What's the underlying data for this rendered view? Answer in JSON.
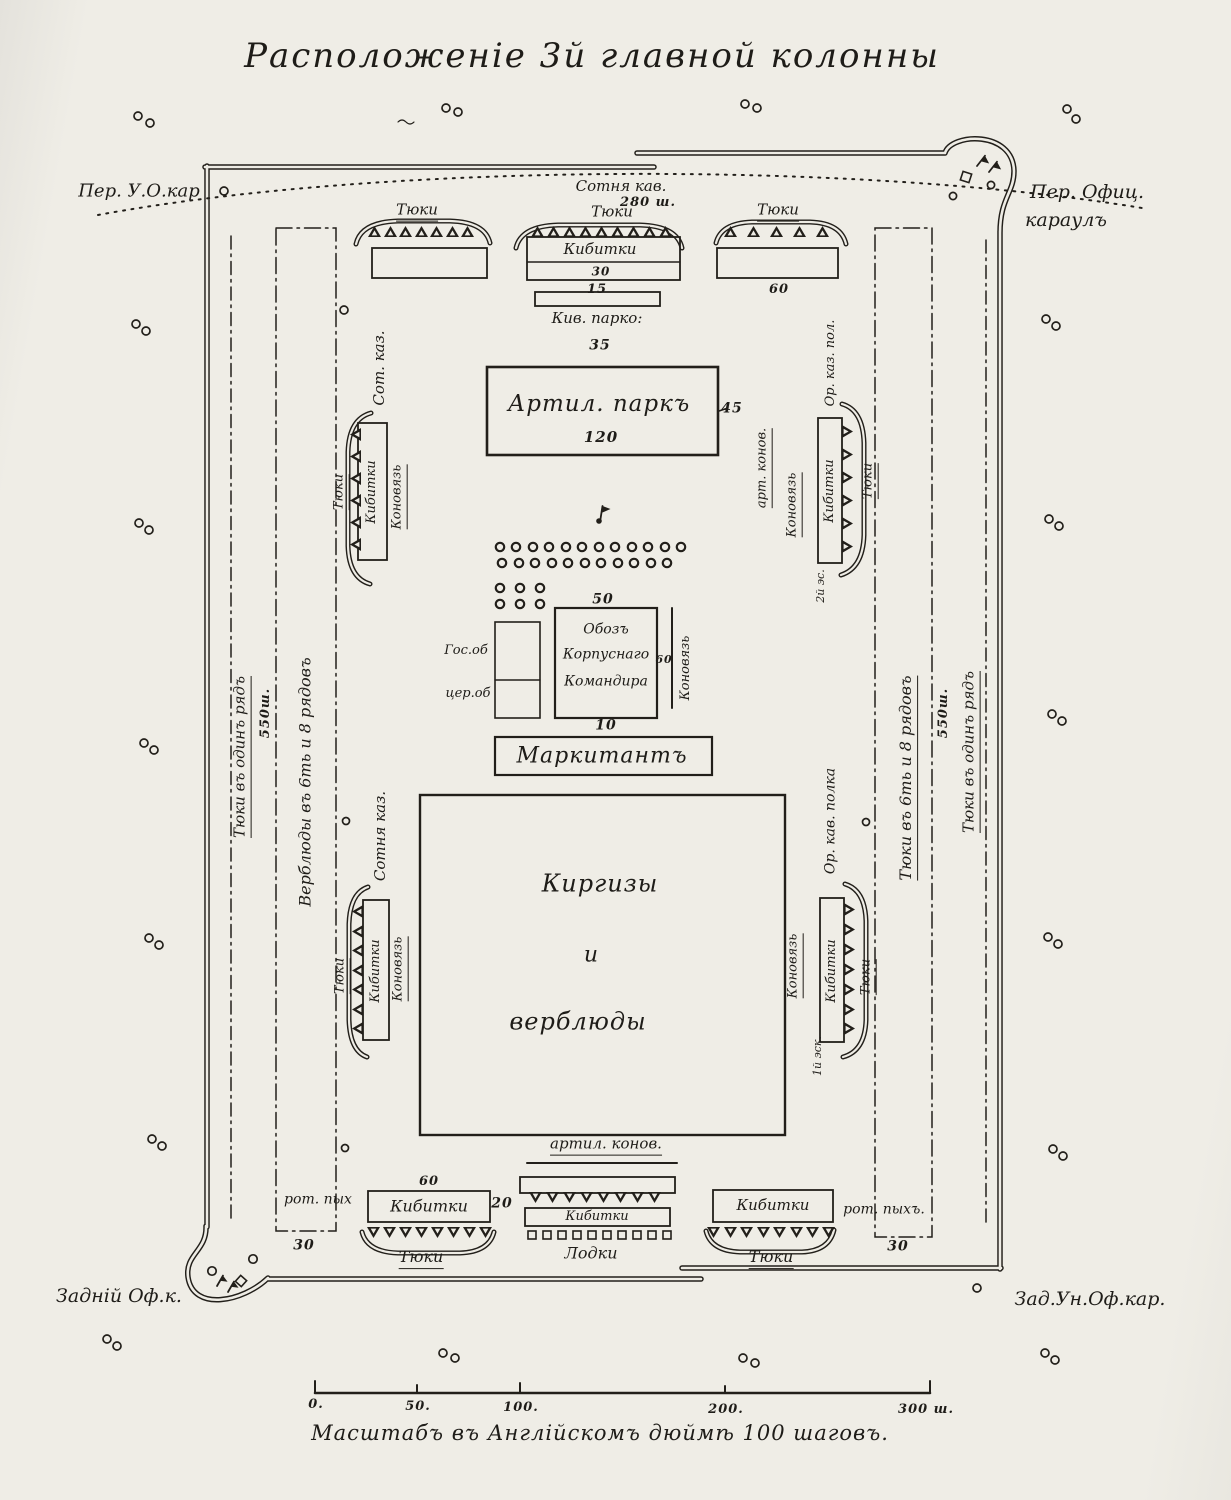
{
  "title": "Расположеніе 3й главной колонны",
  "guards": {
    "top_left": "Пер. У.О.кар",
    "top_right_1": "Пер. Офиц.",
    "top_right_2": "караулъ",
    "bottom_left": "Задній Оф.к.",
    "bottom_right": "Зад.Ун.Оф.кар."
  },
  "top_band": {
    "cavalry": "Сотня кав.",
    "cavalry_width": "280 ш.",
    "tyuki_left": "Тюки",
    "tyuki_center": "Тюки",
    "tyuki_right": "Тюки",
    "kibitki": "Кибитки",
    "kibitki_count": "30",
    "center_below": "15",
    "right_below": "60",
    "kib_park": "Кив. парко:",
    "kib_park_count": "35"
  },
  "artillery_park": {
    "label": "Артил. паркъ",
    "count": "120",
    "side_note": "45"
  },
  "left_wall": {
    "outer": "Тюки въ одинъ рядъ",
    "width": "550ш.",
    "inner": "Верблюды въ 6ть и 8 рядовъ"
  },
  "right_wall": {
    "inner": "Тюки въ 6ть и 8 рядовъ",
    "width": "550ш.",
    "outer": "Тюки въ одинъ рядъ"
  },
  "upper_left": {
    "unit": "Сот. каз.",
    "tyuki": "Тюки",
    "kibitki": "Кибитки",
    "konovyaz": "Коновязь"
  },
  "upper_right": {
    "art_konov": "арт. конов.",
    "konovyaz": "Коновязь",
    "kibitki": "Кибитки",
    "tyuki": "Тюки",
    "squadron": "2й эс.",
    "regiment": "Ор. каз. пол."
  },
  "center": {
    "horses_count": "50",
    "gos_ob": "Гос.об",
    "cer_ob": "цер.об",
    "oboz_1": "Обозъ",
    "oboz_2": "Корпуснаго",
    "oboz_3": "Командира",
    "oboz_right": "60",
    "oboz_below": "10",
    "konovyaz": "Коновязь",
    "markitant": "Маркитантъ"
  },
  "kirgiz": {
    "l1": "Киргизы",
    "l2": "и",
    "l3": "верблюды"
  },
  "middle_left": {
    "unit": "Сотня каз.",
    "tyuki": "Тюки",
    "kibitki": "Кибитки",
    "konovyaz": "Коновязь"
  },
  "middle_right": {
    "regiment": "Ор. кав. полка",
    "konovyaz": "Коновязь",
    "kibitki": "Кибитки",
    "tyuki": "Тюки",
    "squadron": "1й эск."
  },
  "bottom_band": {
    "left": {
      "rot": "рот. пых",
      "above": "60",
      "kibitki": "Кибитки",
      "right": "20",
      "tyuki": "Тюки",
      "strip_count": "30"
    },
    "center": {
      "art_konov": "артил. конов.",
      "kibitki": "Кибитки",
      "lodki": "Лодки"
    },
    "right": {
      "kibitki": "Кибитки",
      "rot": "рот. пыхъ.",
      "tyuki": "Тюки",
      "strip_count": "30"
    }
  },
  "scale_bar": {
    "ticks": [
      "0.",
      "50.",
      "100.",
      "200.",
      "300 ш."
    ],
    "caption": "Масштабъ въ Англійскомъ дюймѣ 100 шаговъ."
  }
}
